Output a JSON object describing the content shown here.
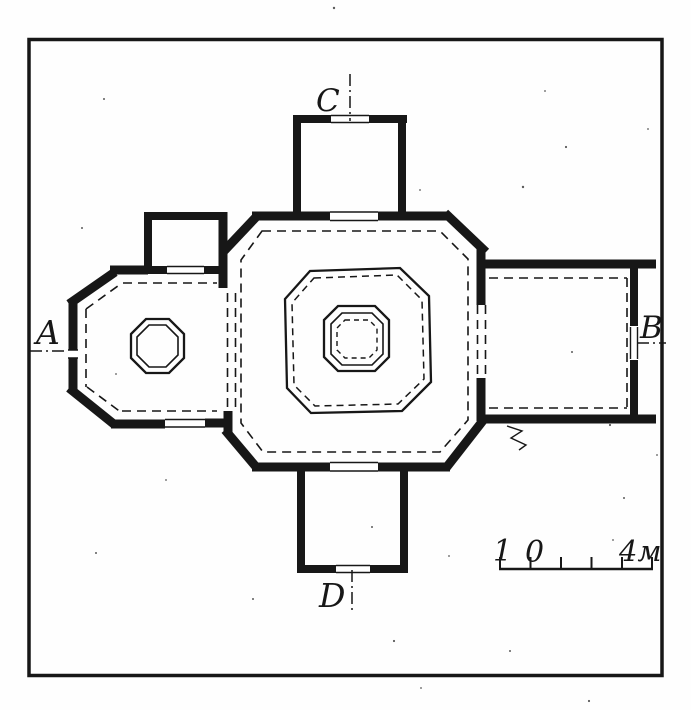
{
  "figure": {
    "ink_color": "#171717",
    "paper_color": "#fefefe"
  },
  "sections": {
    "a": {
      "label": "A"
    },
    "b": {
      "label": "B"
    },
    "c": {
      "label": "C"
    },
    "d": {
      "label": "D"
    }
  },
  "scale_bar": {
    "left_label": "1",
    "zero_label": "0",
    "right_label": "4м"
  }
}
